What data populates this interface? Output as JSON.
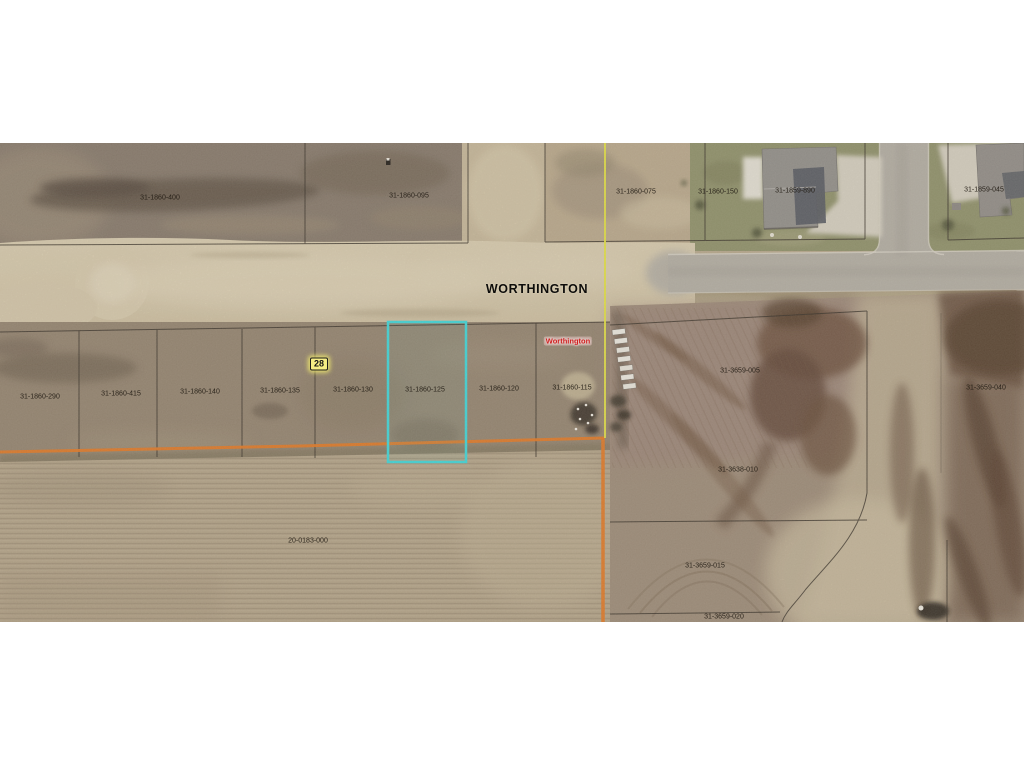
{
  "map": {
    "street_name_label": "WORTHINGTON",
    "place_name_label": "Worthington",
    "highway_marker": "28",
    "selected_parcel": {
      "id": "31-1860-125",
      "highlight_color": "#35dde2"
    },
    "colors": {
      "section_line_orange": "#e8761c",
      "boundary_line_yellow": "#e9e83e",
      "parcel_line_black": "#2b251e",
      "highway_marker_bg": "#f6ee85",
      "place_name_red": "#cf1f1f"
    },
    "parcel_labels": [
      {
        "id": "31-1860-400"
      },
      {
        "id": "31-1860-095"
      },
      {
        "id": "31-1860-075"
      },
      {
        "id": "31-1860-150"
      },
      {
        "id": "31-1859-890"
      },
      {
        "id": "31-1859-045"
      },
      {
        "id": "31-1860-290"
      },
      {
        "id": "31-1860-415"
      },
      {
        "id": "31-1860-140"
      },
      {
        "id": "31-1860-135"
      },
      {
        "id": "31-1860-130"
      },
      {
        "id": "31-1860-125"
      },
      {
        "id": "31-1860-120"
      },
      {
        "id": "31-1860-115"
      },
      {
        "id": "31-3659-005"
      },
      {
        "id": "31-3659-040"
      },
      {
        "id": "31-3638-010"
      },
      {
        "id": "31-3659-015"
      },
      {
        "id": "31-3659-020"
      },
      {
        "id": "20-0183-000"
      }
    ]
  }
}
